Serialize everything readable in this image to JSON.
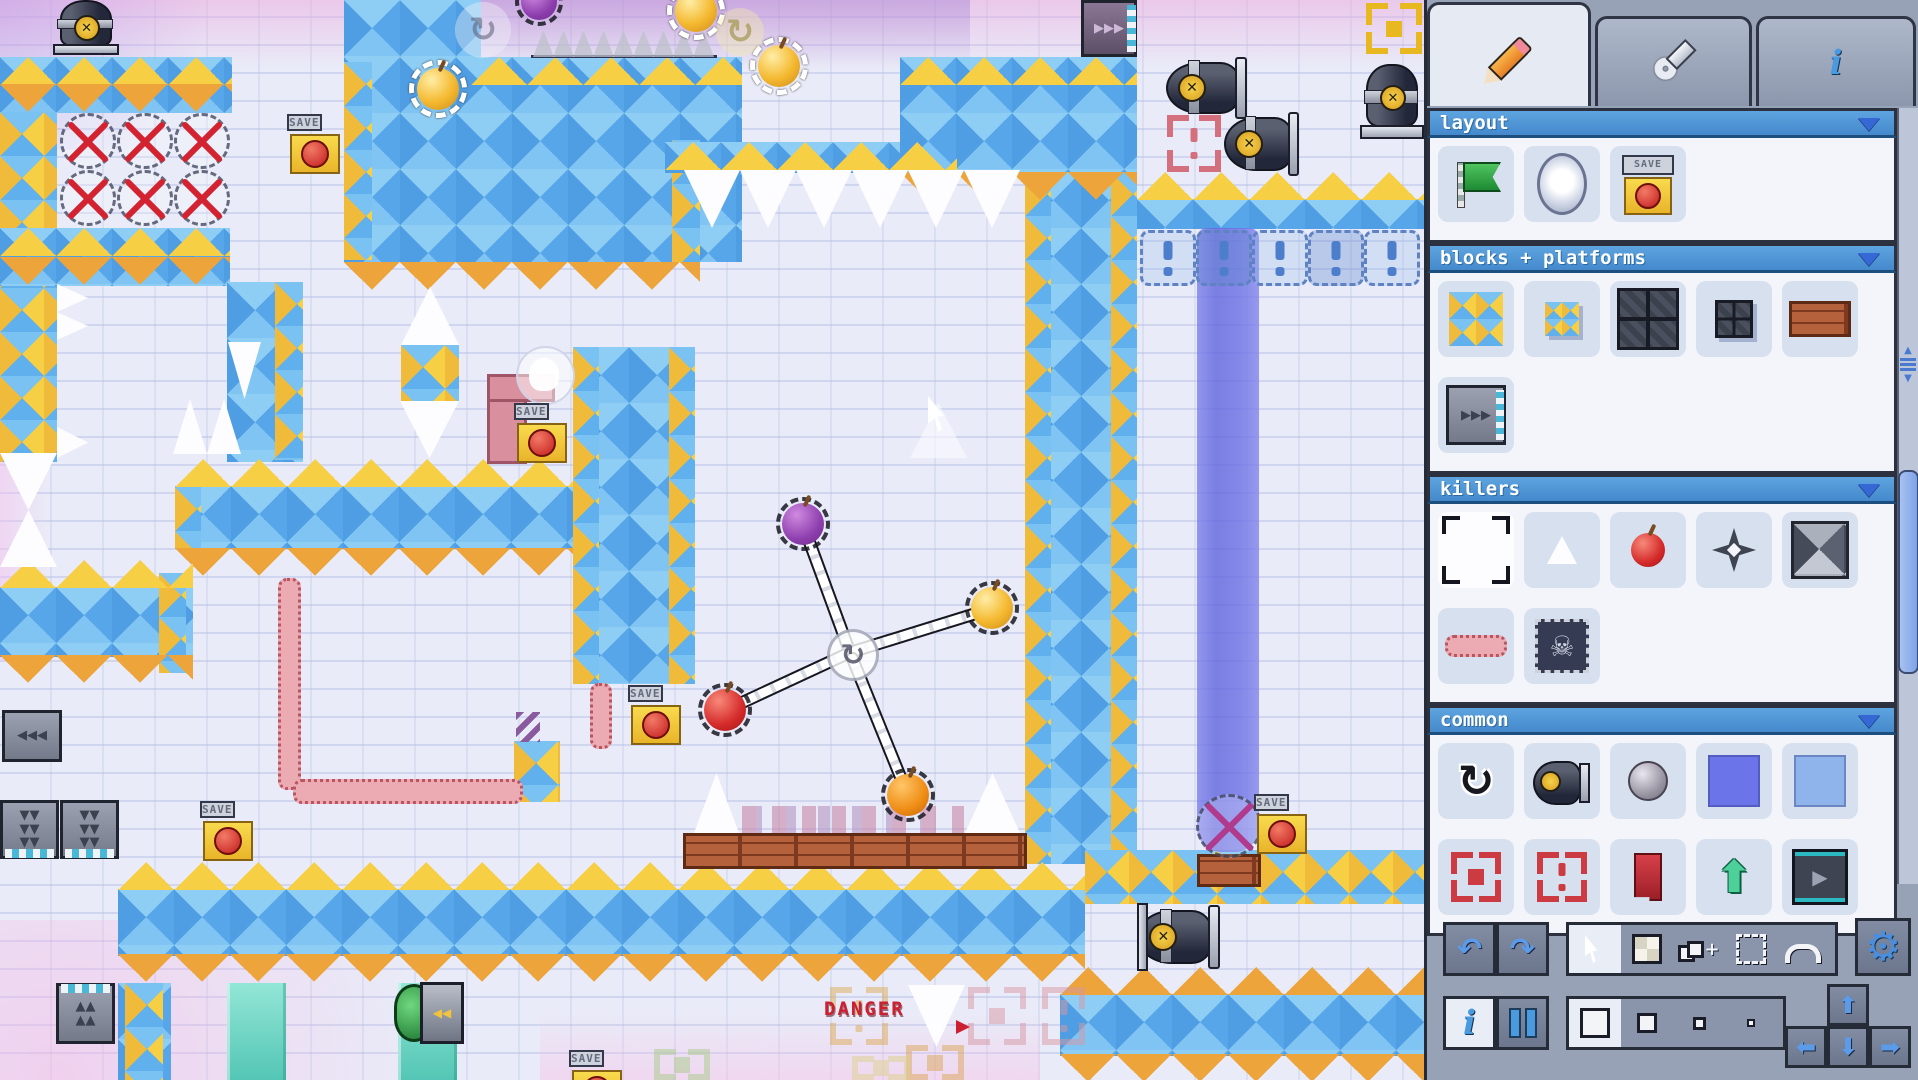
{
  "panel": {
    "tabs": [
      {
        "id": "edit",
        "icon": "pencil-icon",
        "active": true
      },
      {
        "id": "tools",
        "icon": "wrench-icon",
        "active": false
      },
      {
        "id": "info",
        "icon": "info-icon",
        "active": false
      }
    ],
    "info_glyph": "i",
    "sections": [
      {
        "id": "layout",
        "title": "layout",
        "rows": [
          [
            "flag",
            "portal",
            "checkpoint"
          ]
        ]
      },
      {
        "id": "blocks",
        "title": "blocks + platforms",
        "rows": [
          [
            "tile-big",
            "tile-small",
            "grid-big",
            "grid-small",
            "brick"
          ],
          [
            "conveyor"
          ]
        ]
      },
      {
        "id": "killers",
        "title": "killers",
        "rows": [
          [
            "spike-big",
            "spike-small",
            "apple",
            "star",
            "spike-block"
          ],
          [
            "wiggle",
            "skull-block"
          ]
        ]
      },
      {
        "id": "common",
        "title": "common",
        "rows": [
          [
            "rotate",
            "cannon",
            "stone",
            "water-dark",
            "water-light"
          ],
          [
            "bracket-square",
            "bracket-dot",
            "bookmark",
            "arrow-up",
            "play-block"
          ]
        ]
      }
    ],
    "selected_item": "spike-big",
    "toolbar": {
      "tools": [
        "cursor",
        "grid",
        "stamp",
        "marquee",
        "rotate-arc"
      ],
      "active_tool": "cursor",
      "sizes": [
        30,
        20,
        13,
        8
      ],
      "active_size": 0,
      "dpad": [
        "up",
        "left",
        "down",
        "right"
      ]
    },
    "colors": {
      "header": "#4a94d6",
      "accent": "#4a8ee0",
      "section_bg": "#f3f5fa",
      "item_bg": "#d6e0ee",
      "panel_bg": "#98a2b6"
    }
  },
  "game": {
    "labels": {
      "save": "SAVE",
      "danger": "DANGER"
    },
    "colors": {
      "tile_blue": "#5fa9ea",
      "tile_gold": "#f6cf45",
      "cren_orange": "#eda43b",
      "water": "#6b6fe0",
      "teal": "#62d0c0",
      "wiggle_pink": "#ecaab2"
    },
    "plats": [
      [
        0,
        57,
        232,
        56,
        "chk"
      ],
      [
        0,
        112,
        57,
        350,
        "dia"
      ],
      [
        0,
        228,
        230,
        58,
        "chk"
      ],
      [
        227,
        282,
        76,
        180,
        "chk"
      ],
      [
        275,
        282,
        28,
        178,
        "dia"
      ],
      [
        344,
        0,
        137,
        62,
        "chk"
      ],
      [
        344,
        57,
        398,
        205,
        "chk"
      ],
      [
        344,
        62,
        28,
        198,
        "dia"
      ],
      [
        672,
        140,
        28,
        122,
        "dia"
      ],
      [
        665,
        142,
        292,
        31,
        "chk"
      ],
      [
        900,
        57,
        237,
        117,
        "chk"
      ],
      [
        1025,
        172,
        112,
        692,
        "chk"
      ],
      [
        1025,
        172,
        26,
        692,
        "dia"
      ],
      [
        1111,
        172,
        26,
        692,
        "dia"
      ],
      [
        1137,
        199,
        287,
        30,
        "chk"
      ],
      [
        175,
        486,
        398,
        63,
        "chk"
      ],
      [
        175,
        487,
        26,
        61,
        "dia"
      ],
      [
        573,
        347,
        122,
        337,
        "chk"
      ],
      [
        573,
        347,
        26,
        337,
        "dia"
      ],
      [
        669,
        347,
        26,
        337,
        "dia"
      ],
      [
        0,
        587,
        193,
        70,
        "chk"
      ],
      [
        159,
        573,
        27,
        100,
        "dia"
      ],
      [
        118,
        889,
        967,
        67,
        "chk"
      ],
      [
        118,
        983,
        53,
        97,
        "chk"
      ],
      [
        125,
        983,
        38,
        97,
        "dia"
      ],
      [
        1085,
        850,
        339,
        54,
        "dia"
      ],
      [
        1060,
        994,
        364,
        62,
        "chk"
      ],
      [
        514,
        741,
        46,
        61,
        "dia"
      ],
      [
        401,
        345,
        58,
        56,
        "dia"
      ]
    ],
    "crens": [
      [
        0,
        57,
        232,
        "u",
        "g"
      ],
      [
        0,
        84,
        232,
        "d",
        "o"
      ],
      [
        0,
        228,
        230,
        "u",
        "g"
      ],
      [
        0,
        257,
        230,
        "d",
        "o"
      ],
      [
        471,
        57,
        271,
        "u",
        "g"
      ],
      [
        344,
        262,
        356,
        "d",
        "o"
      ],
      [
        665,
        142,
        292,
        "u",
        "g"
      ],
      [
        900,
        57,
        237,
        "u",
        "g"
      ],
      [
        900,
        172,
        237,
        "d",
        "o"
      ],
      [
        1137,
        172,
        287,
        "u",
        "g"
      ],
      [
        175,
        459,
        398,
        "u",
        "g"
      ],
      [
        175,
        548,
        398,
        "d",
        "o"
      ],
      [
        0,
        560,
        193,
        "u",
        "g"
      ],
      [
        0,
        655,
        193,
        "d",
        "o"
      ],
      [
        118,
        862,
        967,
        "u",
        "g"
      ],
      [
        118,
        954,
        967,
        "d",
        "o"
      ],
      [
        1060,
        967,
        364,
        "u",
        "o"
      ],
      [
        1060,
        1054,
        364,
        "d",
        "o"
      ]
    ],
    "spikes": [
      [
        684,
        170,
        56,
        58,
        "d"
      ],
      [
        740,
        170,
        56,
        58,
        "d"
      ],
      [
        796,
        170,
        56,
        58,
        "d"
      ],
      [
        852,
        170,
        56,
        58,
        "d"
      ],
      [
        908,
        170,
        56,
        58,
        "d"
      ],
      [
        964,
        170,
        56,
        58,
        "d"
      ],
      [
        533,
        30,
        21,
        27,
        "u",
        "thin"
      ],
      [
        553,
        30,
        21,
        27,
        "u",
        "thin"
      ],
      [
        573,
        30,
        21,
        27,
        "u",
        "thin"
      ],
      [
        593,
        30,
        21,
        27,
        "u",
        "thin"
      ],
      [
        613,
        30,
        21,
        27,
        "u",
        "thin"
      ],
      [
        633,
        30,
        21,
        27,
        "u",
        "thin"
      ],
      [
        653,
        30,
        21,
        27,
        "u",
        "thin"
      ],
      [
        673,
        30,
        21,
        27,
        "u",
        "thin"
      ],
      [
        693,
        30,
        21,
        27,
        "u",
        "thin"
      ],
      [
        173,
        399,
        34,
        55,
        "u"
      ],
      [
        207,
        399,
        34,
        55,
        "u"
      ],
      [
        228,
        342,
        33,
        57,
        "d"
      ],
      [
        401,
        287,
        58,
        58,
        "u"
      ],
      [
        400,
        401,
        59,
        57,
        "d"
      ],
      [
        57,
        284,
        31,
        28,
        "r"
      ],
      [
        57,
        312,
        31,
        28,
        "r"
      ],
      [
        57,
        427,
        31,
        31,
        "r"
      ],
      [
        0,
        453,
        57,
        57,
        "d"
      ],
      [
        0,
        510,
        57,
        57,
        "u"
      ],
      [
        694,
        773,
        45,
        60,
        "u"
      ],
      [
        965,
        773,
        55,
        60,
        "u"
      ],
      [
        908,
        985,
        57,
        62,
        "d"
      ]
    ],
    "spikeline": {
      "x": 531,
      "y": 55,
      "w": 186,
      "h": 3
    },
    "xgrid": {
      "x": 60,
      "y": 113,
      "cols": 3,
      "rows": 2,
      "cell": 57
    },
    "xsingle": {
      "x": 1196,
      "y": 794,
      "w": 60,
      "h": 58
    },
    "orbs": [
      {
        "x": 409,
        "y": 60
      },
      {
        "x": 667,
        "y": -18
      },
      {
        "x": 750,
        "y": 37
      }
    ],
    "topball": {
      "x": 515,
      "y": -22
    },
    "rotghosts": [
      {
        "x": 455,
        "y": 2,
        "s": 56,
        "tint": "gray"
      },
      {
        "x": 716,
        "y": 8,
        "s": 48,
        "tint": "gold"
      }
    ],
    "windmill": {
      "hub": {
        "x": 850,
        "y": 652
      },
      "balls": [
        {
          "x": 803,
          "y": 524,
          "c": "purple"
        },
        {
          "x": 992,
          "y": 608,
          "c": "gold"
        },
        {
          "x": 725,
          "y": 710,
          "c": "red"
        },
        {
          "x": 908,
          "y": 795,
          "c": "orange"
        }
      ]
    },
    "saves": [
      [
        287,
        113
      ],
      [
        514,
        402
      ],
      [
        628,
        684
      ],
      [
        200,
        800
      ],
      [
        569,
        1049
      ],
      [
        1254,
        793
      ]
    ],
    "conveyors": [
      {
        "x": 2,
        "y": 710,
        "w": 60,
        "h": 52,
        "dir": "l"
      },
      {
        "x": 0,
        "y": 800,
        "w": 59,
        "h": 59,
        "dir": "d"
      },
      {
        "x": 60,
        "y": 800,
        "w": 59,
        "h": 59,
        "dir": "d"
      },
      {
        "x": 56,
        "y": 983,
        "w": 59,
        "h": 61,
        "dir": "u"
      },
      {
        "x": 1081,
        "y": 0,
        "w": 56,
        "h": 57,
        "dir": "r"
      }
    ],
    "cannons": [
      {
        "x": 1166,
        "y": 57,
        "w": 86,
        "h": 58,
        "o": "h"
      },
      {
        "x": 1224,
        "y": 112,
        "w": 80,
        "h": 60,
        "o": "h"
      },
      {
        "x": 1362,
        "y": 64,
        "w": 56,
        "h": 75,
        "o": "v"
      },
      {
        "x": 1137,
        "y": 905,
        "w": 88,
        "h": 60,
        "o": "h",
        "plate": true
      },
      {
        "x": 55,
        "y": 0,
        "w": 58,
        "h": 55,
        "o": "v"
      }
    ],
    "brackets": [
      {
        "x": 1366,
        "y": 3,
        "w": 56,
        "h": 51,
        "c": "#e8b820",
        "t": "square"
      },
      {
        "x": 1167,
        "y": 115,
        "w": 54,
        "h": 57,
        "c": "#d4707e",
        "t": "dot"
      },
      {
        "x": 654,
        "y": 1049,
        "w": 56,
        "h": 31,
        "c": "#a8cc88",
        "t": "square",
        "f": 1
      },
      {
        "x": 830,
        "y": 987,
        "w": 58,
        "h": 58,
        "c": "#ddab57",
        "t": "dot",
        "f": 1
      },
      {
        "x": 968,
        "y": 987,
        "w": 58,
        "h": 58,
        "c": "#d898a4",
        "t": "square",
        "f": 1
      },
      {
        "x": 1042,
        "y": 987,
        "w": 43,
        "h": 58,
        "c": "#d898a4",
        "t": "dot",
        "f": 1
      },
      {
        "x": 906,
        "y": 1045,
        "w": 58,
        "h": 35,
        "c": "#dda657",
        "t": "square",
        "f": 1
      },
      {
        "x": 852,
        "y": 1056,
        "w": 58,
        "h": 24,
        "c": "#ddd28a",
        "t": "square",
        "f": 1
      }
    ],
    "water": {
      "x": 1197,
      "y": 228,
      "w": 62,
      "h": 624
    },
    "toggles": {
      "x": 1140,
      "y": 230,
      "n": 5,
      "s": 56
    },
    "teals": [
      [
        227,
        983,
        59,
        97
      ],
      [
        398,
        983,
        59,
        97
      ]
    ],
    "wiggles": [
      {
        "x": 278,
        "y": 578,
        "w": 17,
        "h": 206,
        "o": "v"
      },
      {
        "x": 293,
        "y": 779,
        "w": 224,
        "h": 19,
        "o": "h"
      },
      {
        "x": 590,
        "y": 683,
        "w": 16,
        "h": 60,
        "o": "v"
      }
    ],
    "purplezig": {
      "x": 516,
      "y": 712,
      "w": 24,
      "h": 30
    },
    "pipe": {
      "x": 487,
      "y": 374,
      "w": 34,
      "h": 84
    },
    "brickrows": [
      [
        683,
        833,
        338,
        30
      ],
      [
        1197,
        854,
        58,
        27
      ]
    ],
    "decor": {
      "x": 742,
      "y": 806,
      "w": 222,
      "h": 27
    },
    "machine": {
      "x": 394,
      "y": 982,
      "w": 64,
      "h": 60
    },
    "danger": {
      "x": 824,
      "y": 998
    },
    "ghostcircle": {
      "x": 516,
      "y": 346,
      "s": 55
    },
    "ghosttri": {
      "x": 910,
      "y": 403,
      "w": 57,
      "h": 55
    },
    "cursor": {
      "x": 928,
      "y": 396
    }
  }
}
